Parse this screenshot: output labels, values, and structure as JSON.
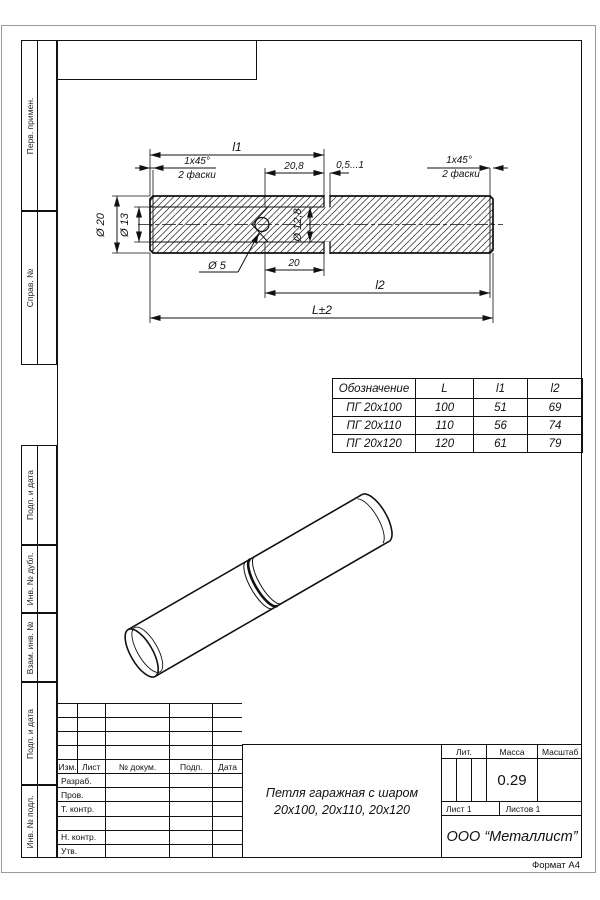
{
  "page": {
    "format_label": "Формат А4"
  },
  "margin_labels": {
    "perv": "Перв. примен.",
    "sprav": "Справ. №",
    "podp1": "Подп. и дата",
    "inv_dubl": "Инв. № дубл.",
    "vzam": "Взам. инв. №",
    "podp2": "Подп. и дата",
    "inv_podl": "Инв. № подл."
  },
  "drawing": {
    "dims": {
      "l1": "l1",
      "chamfer": "1x45°",
      "chamfer_note": "2 фаски",
      "bore_depth": "20,8",
      "gap": "0,5...1",
      "d20": "Ø 20",
      "d13": "Ø 13",
      "d128": "Ø 12,8",
      "d5": "Ø 5",
      "pin_len": "20",
      "l2": "l2",
      "length": "L±2"
    }
  },
  "size_table": {
    "headers": [
      "Обозначение",
      "L",
      "l1",
      "l2"
    ],
    "rows": [
      [
        "ПГ  20x100",
        "100",
        "51",
        "69"
      ],
      [
        "ПГ  20x110",
        "110",
        "56",
        "74"
      ],
      [
        "ПГ  20x120",
        "120",
        "61",
        "79"
      ]
    ]
  },
  "title_block": {
    "rev_header": [
      "Изм.",
      "Лист",
      "№ докум.",
      "Подп.",
      "Дата"
    ],
    "row_labels": [
      "Разраб.",
      "Пров.",
      "Т. контр.",
      "",
      "Н. контр.",
      "Утв."
    ],
    "title_line1": "Петля гаражная с шаром",
    "title_line2": "20х100,  20х110,  20х120",
    "lit_label": "Лит.",
    "mass_label": "Масса",
    "scale_label": "Масштаб",
    "mass_value": "0.29",
    "sheet_label": "Лист 1",
    "sheets_label": "Листов 1",
    "company": "ООО  “Металлист”"
  }
}
